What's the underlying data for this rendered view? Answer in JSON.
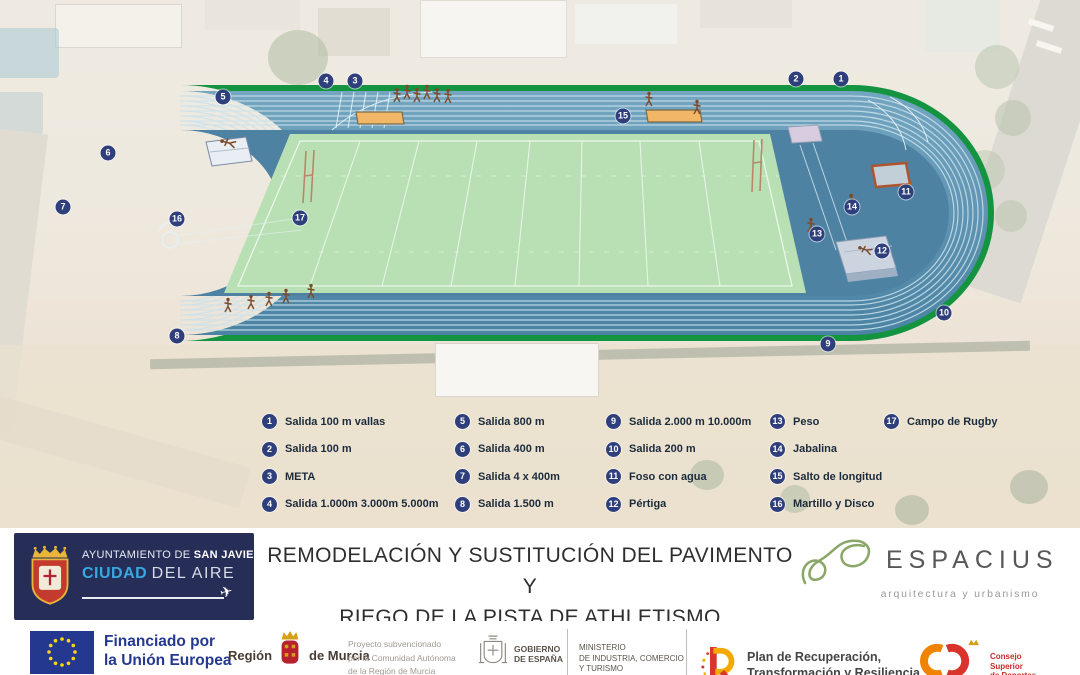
{
  "map": {
    "markers": [
      {
        "n": "1",
        "x": 841,
        "y": 79
      },
      {
        "n": "2",
        "x": 796,
        "y": 79
      },
      {
        "n": "3",
        "x": 355,
        "y": 81
      },
      {
        "n": "4",
        "x": 326,
        "y": 81
      },
      {
        "n": "5",
        "x": 223,
        "y": 97
      },
      {
        "n": "6",
        "x": 108,
        "y": 153
      },
      {
        "n": "7",
        "x": 63,
        "y": 207
      },
      {
        "n": "8",
        "x": 177,
        "y": 336
      },
      {
        "n": "9",
        "x": 828,
        "y": 344
      },
      {
        "n": "10",
        "x": 944,
        "y": 313
      },
      {
        "n": "11",
        "x": 906,
        "y": 192
      },
      {
        "n": "12",
        "x": 882,
        "y": 251
      },
      {
        "n": "13",
        "x": 817,
        "y": 234
      },
      {
        "n": "14",
        "x": 852,
        "y": 207
      },
      {
        "n": "15",
        "x": 623,
        "y": 116
      },
      {
        "n": "16",
        "x": 177,
        "y": 219
      },
      {
        "n": "17",
        "x": 300,
        "y": 218
      }
    ],
    "legend": {
      "items": [
        {
          "n": "1",
          "label": "Salida 100 m vallas"
        },
        {
          "n": "2",
          "label": "Salida 100 m"
        },
        {
          "n": "3",
          "label": "META"
        },
        {
          "n": "4",
          "label": "Salida 1.000m 3.000m 5.000m"
        },
        {
          "n": "5",
          "label": "Salida 800 m"
        },
        {
          "n": "6",
          "label": "Salida 400 m"
        },
        {
          "n": "7",
          "label": "Salida 4 x 400m"
        },
        {
          "n": "8",
          "label": "Salida 1.500 m"
        },
        {
          "n": "9",
          "label": "Salida 2.000 m 10.000m"
        },
        {
          "n": "10",
          "label": "Salida 200 m"
        },
        {
          "n": "11",
          "label": "Foso con agua"
        },
        {
          "n": "12",
          "label": "Pértiga"
        },
        {
          "n": "13",
          "label": "Peso"
        },
        {
          "n": "14",
          "label": "Jabalina"
        },
        {
          "n": "15",
          "label": "Salto de longitud"
        },
        {
          "n": "16",
          "label": "Martillo y Disco"
        },
        {
          "n": "17",
          "label": "Campo de Rugby"
        }
      ]
    }
  },
  "footer": {
    "sanjavier": {
      "line1_normal": "AYUNTAMIENTO DE ",
      "line1_bold": "SAN JAVIER",
      "line2_blue": "CIUDAD",
      "line2_rest": "DEL AIRE"
    },
    "title_line1": "REMODELACIÓN Y SUSTITUCIÓN DEL PAVIMENTO Y",
    "title_line2": "RIEGO DE LA PISTA DE ATHLETISMO",
    "espacius": {
      "name": "ESPACIUS",
      "tagline": "arquitectura y urbanismo"
    }
  },
  "funding": {
    "eu": {
      "line1": "Financiado por",
      "line2": "la Unión Europea",
      "line3": "NextGenerationEU"
    },
    "murcia": {
      "left": "Región",
      "right": "de Murcia"
    },
    "subsidy": [
      "Proyecto subvencionado",
      "por la Comunidad Autónoma",
      "de la Región de Murcia"
    ],
    "gobierno": {
      "line1": "GOBIERNO",
      "line2": "DE ESPAÑA"
    },
    "ministerio": [
      "MINISTERIO",
      "DE INDUSTRIA, COMERCIO",
      "Y TURISMO"
    ],
    "plan": {
      "line1": "Plan de Recuperación,",
      "line2": "Transformación y Resiliencia"
    },
    "csd": [
      "Consejo",
      "Superior",
      "de Deportes"
    ]
  },
  "colors": {
    "track_blue": "#5b93b2",
    "track_border_green": "#149440",
    "infield_green": "#b9e0b4",
    "marker_badge": "#2e3f7c",
    "eu_blue": "#24388f",
    "eu_star": "#ffd617",
    "navy_panel": "#262e58",
    "ciudad_blue": "#38a8e0",
    "espacius_green": "#8aa768",
    "plan_red": "#d8342c",
    "plan_yellow": "#f5a800",
    "csd_red": "#cc2b28",
    "sand_pit_orange": "#f2b766"
  }
}
